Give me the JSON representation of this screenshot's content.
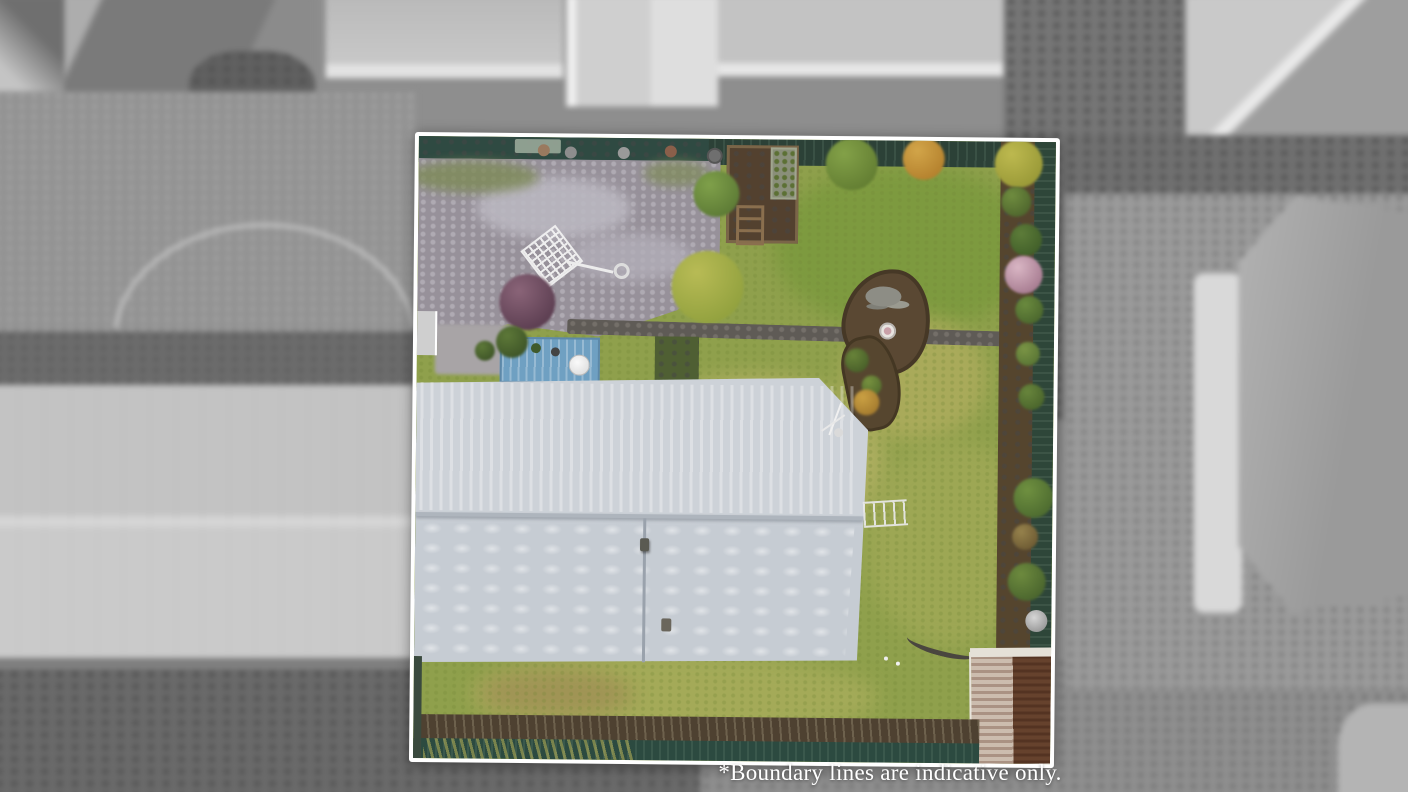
{
  "photo": {
    "kind": "aerial drone photograph of a residential property",
    "treatment": "subject property shown in colour inside a white boundary outline; surrounding properties desaturated to black-and-white and blurred",
    "caption": "*Boundary lines are indicative only."
  },
  "boundary": {
    "outline_color": "#ffffff",
    "shape": "slightly rotated rectangle"
  },
  "palette": {
    "lawn_green": "#8fa04c",
    "fence_hedge_green": "#31473c",
    "gravel_grey": "#97919a",
    "garden_soil_brown": "#53412f",
    "deck_blue": "#6fa0c2",
    "house_roof_grey": "#c9ced4",
    "shed_rust_brown": "#6b4a34",
    "caption_text": "#ffffff",
    "surroundings_grey": "#8e8e8e"
  }
}
